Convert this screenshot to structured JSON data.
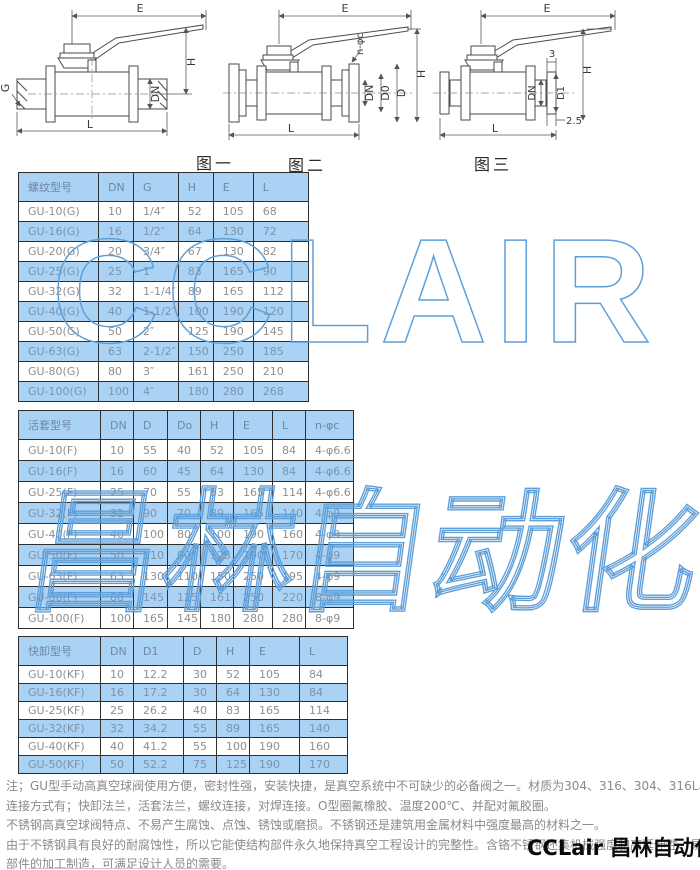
{
  "figures": [
    {
      "caption": "图一",
      "dims": [
        "E",
        "H",
        "G",
        "DN",
        "L"
      ]
    },
    {
      "caption": "图二",
      "dims": [
        "E",
        "n-φc",
        "H",
        "DN",
        "D0",
        "D",
        "L"
      ]
    },
    {
      "caption": "图三",
      "dims": [
        "E",
        "3",
        "H",
        "DN",
        "D1",
        "2.5",
        "L"
      ]
    }
  ],
  "tables": [
    {
      "headers": [
        "螺纹型号",
        "DN",
        "G",
        "H",
        "E",
        "L"
      ],
      "rows": [
        [
          "GU-10(G)",
          "10",
          "1/4″",
          "52",
          "105",
          "68"
        ],
        [
          "GU-16(G)",
          "16",
          "1/2″",
          "64",
          "130",
          "72"
        ],
        [
          "GU-20(G)",
          "20",
          "3/4″",
          "67",
          "130",
          "82"
        ],
        [
          "GU-25(G)",
          "25",
          "1″",
          "83",
          "165",
          "90"
        ],
        [
          "GU-32(G)",
          "32",
          "1-1/4″",
          "89",
          "165",
          "112"
        ],
        [
          "GU-40(G)",
          "40",
          "1-1/2″",
          "100",
          "190",
          "120"
        ],
        [
          "GU-50(G)",
          "50",
          "2″",
          "125",
          "190",
          "145"
        ],
        [
          "GU-63(G)",
          "63",
          "2-1/2″",
          "150",
          "250",
          "185"
        ],
        [
          "GU-80(G)",
          "80",
          "3″",
          "161",
          "250",
          "210"
        ],
        [
          "GU-100(G)",
          "100",
          "4″",
          "180",
          "280",
          "268"
        ]
      ]
    },
    {
      "headers": [
        "活套型号",
        "DN",
        "D",
        "Do",
        "H",
        "E",
        "L",
        "n-φc"
      ],
      "rows": [
        [
          "GU-10(F)",
          "10",
          "55",
          "40",
          "52",
          "105",
          "84",
          "4-φ6.6"
        ],
        [
          "GU-16(F)",
          "16",
          "60",
          "45",
          "64",
          "130",
          "84",
          "4-φ6.6"
        ],
        [
          "GU-25(F)",
          "25",
          "70",
          "55",
          "83",
          "165",
          "114",
          "4-φ6.6"
        ],
        [
          "GU-32(F)",
          "32",
          "90",
          "70",
          "89",
          "165",
          "140",
          "4-φ9"
        ],
        [
          "GU-40(F)",
          "40",
          "100",
          "80",
          "100",
          "190",
          "160",
          "4-φ9"
        ],
        [
          "GU-50(F)",
          "50",
          "110",
          "90",
          "125",
          "190",
          "170",
          "4-φ9"
        ],
        [
          "GU-63(F)",
          "63",
          "130",
          "110",
          "150",
          "250",
          "195",
          "4-φ9"
        ],
        [
          "GU-80(F)",
          "80",
          "145",
          "125",
          "161",
          "250",
          "220",
          "8-φ9"
        ],
        [
          "GU-100(F)",
          "100",
          "165",
          "145",
          "180",
          "280",
          "280",
          "8-φ9"
        ]
      ]
    },
    {
      "headers": [
        "快卸型号",
        "DN",
        "D1",
        "D",
        "H",
        "E",
        "L"
      ],
      "rows": [
        [
          "GU-10(KF)",
          "10",
          "12.2",
          "30",
          "52",
          "105",
          "84"
        ],
        [
          "GU-16(KF)",
          "16",
          "17.2",
          "30",
          "64",
          "130",
          "84"
        ],
        [
          "GU-25(KF)",
          "25",
          "26.2",
          "40",
          "83",
          "165",
          "114"
        ],
        [
          "GU-32(KF)",
          "32",
          "34.2",
          "55",
          "89",
          "165",
          "140"
        ],
        [
          "GU-40(KF)",
          "40",
          "41.2",
          "55",
          "100",
          "190",
          "160"
        ],
        [
          "GU-50(KF)",
          "50",
          "52.2",
          "75",
          "125",
          "190",
          "170"
        ]
      ]
    }
  ],
  "notes": [
    "注；GU型手动高真空球阀使用方便，密封性强，安装快捷，是真空系统中不可缺少的必备阀之一。材质为304、316、304、316L、等材质。",
    "连接方式有；快卸法兰，活套法兰，螺纹连接，对焊连接。O型圈氟橡胶、温度200℃、并配对氟胶圈。",
    "不锈钢高真空球阀特点、不易产生腐蚀、点蚀、锈蚀或磨损。不锈钢还是建筑用金属材料中强度最高的材料之一。",
    "由于不锈钢具有良好的耐腐蚀性，所以它能使结构部件永久地保持真空工程设计的完整性。含铬不锈钢还集机械强度和高延伸性、易于",
    "部件的加工制造，可满足设计人员的需要。"
  ],
  "watermarks": {
    "latin": "CCLAIR",
    "cjk": "昌林自动化"
  },
  "brand": "CCLair 昌林自动化",
  "colors": {
    "table_blue": "#a9d2f4",
    "watermark_blue": "#5f9fd9",
    "note_gray": "#8a8a8a"
  }
}
